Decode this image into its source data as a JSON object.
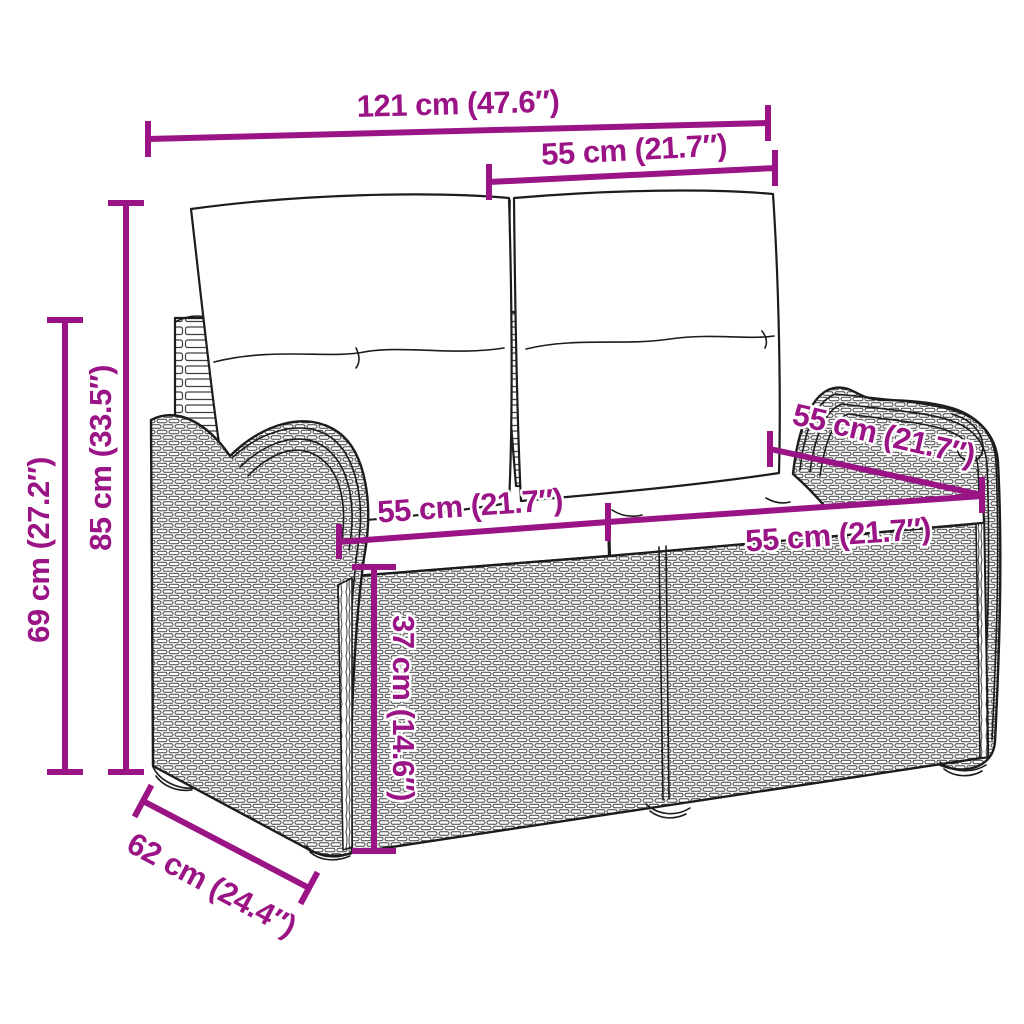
{
  "canvas": {
    "width": 1024,
    "height": 1024,
    "background": "#FFFFFF"
  },
  "colors": {
    "dimension_accent": "#9B1486",
    "drawing_line": "#1C1C1C"
  },
  "illustration": {
    "name": "poly-rattan-garden-bench-2-seater-with-cushions",
    "parts": [
      "back-cushion-left",
      "back-cushion-right",
      "seat-cushion-left",
      "seat-cushion-right",
      "left-armrest",
      "right-armrest",
      "wicker-base",
      "back-post-left",
      "back-post-middle",
      "feet"
    ]
  },
  "dims": {
    "overall_width": {
      "label": "121 cm (47.6″)"
    },
    "backrest_section_width": {
      "label": "55 cm (21.7″)"
    },
    "overall_height": {
      "label": "85 cm (33.5″)"
    },
    "armrest_height": {
      "label": "69 cm (27.2″)"
    },
    "seat_width_left": {
      "label": "55 cm (21.7″)"
    },
    "seat_width_right": {
      "label": "55 cm (21.7″)"
    },
    "seat_depth": {
      "label": "55 cm (21.7″)"
    },
    "seat_height": {
      "label": "37 cm (14.6″)"
    },
    "base_depth": {
      "label": "62 cm (24.4″)"
    }
  }
}
